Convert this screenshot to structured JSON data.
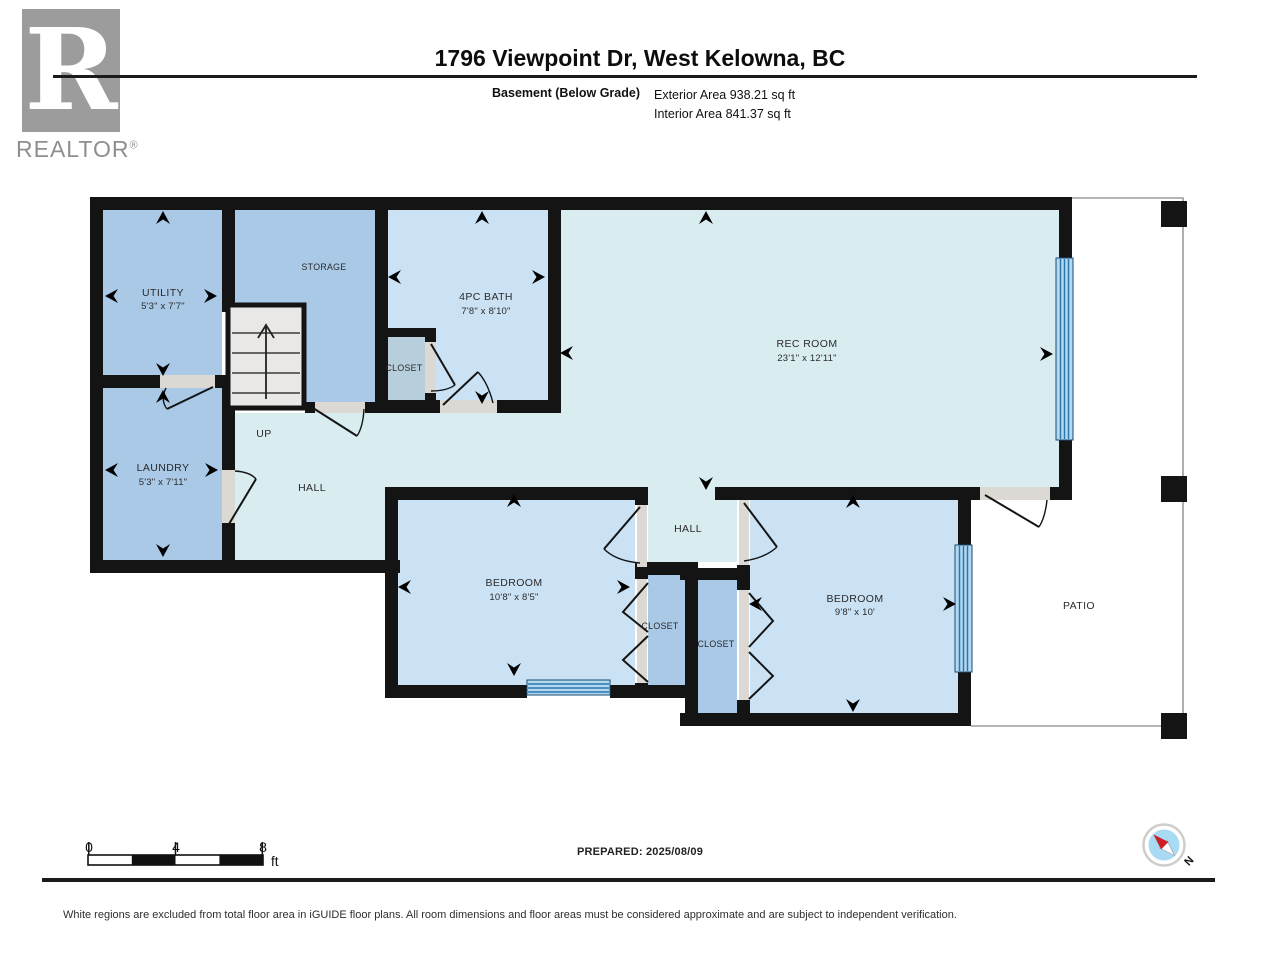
{
  "header": {
    "logo_letter": "R",
    "logo_brand": "REALTOR",
    "logo_reg": "®",
    "title": "1796 Viewpoint Dr, West Kelowna, BC",
    "floor_label": "Basement (Below Grade)",
    "exterior_area": "Exterior Area 938.21 sq ft",
    "interior_area": "Interior Area 841.37 sq ft"
  },
  "plan": {
    "rooms": [
      {
        "name": "UTILITY",
        "dims": "5'3\" x 7'7\""
      },
      {
        "name": "LAUNDRY",
        "dims": "5'3\" x 7'11\""
      },
      {
        "name": "STORAGE",
        "dims": ""
      },
      {
        "name": "4PC BATH",
        "dims": "7'8\" x 8'10\""
      },
      {
        "name": "REC ROOM",
        "dims": "23'1\" x 12'11\""
      },
      {
        "name": "BEDROOM",
        "dims": "10'8\" x 8'5\""
      },
      {
        "name": "BEDROOM",
        "dims": "9'8\" x 10'"
      },
      {
        "name": "CLOSET"
      },
      {
        "name": "CLOSET"
      },
      {
        "name": "CLOSET"
      },
      {
        "name": "HALL"
      },
      {
        "name": "HALL"
      },
      {
        "name": "PATIO"
      },
      {
        "name": "UP"
      }
    ],
    "colors": {
      "wall": "#141414",
      "room_blue": "#a9c9e7",
      "room_light_blue": "#cbe2f5",
      "room_cyan": "#d9edf1",
      "closet_grey": "#b7cedd",
      "door_grey": "#dcd8d3",
      "stair_fill": "#e9e8e6",
      "window_line": "#2d76ad",
      "window_fill": "#b3d9f0",
      "patio_outline": "#9b9b9b",
      "compass_red": "#cb2026",
      "compass_blue": "#a9daf3",
      "logo_grey": "#9c9c9c"
    }
  },
  "scale": {
    "ticks": [
      "0",
      "4",
      "8"
    ],
    "unit": "ft"
  },
  "footer": {
    "prepared": "PREPARED: 2025/08/09",
    "disclaimer": "White regions are excluded from total floor area in iGUIDE floor plans. All room dimensions and floor areas must be considered approximate and are subject to independent verification.",
    "compass_n": "N"
  }
}
